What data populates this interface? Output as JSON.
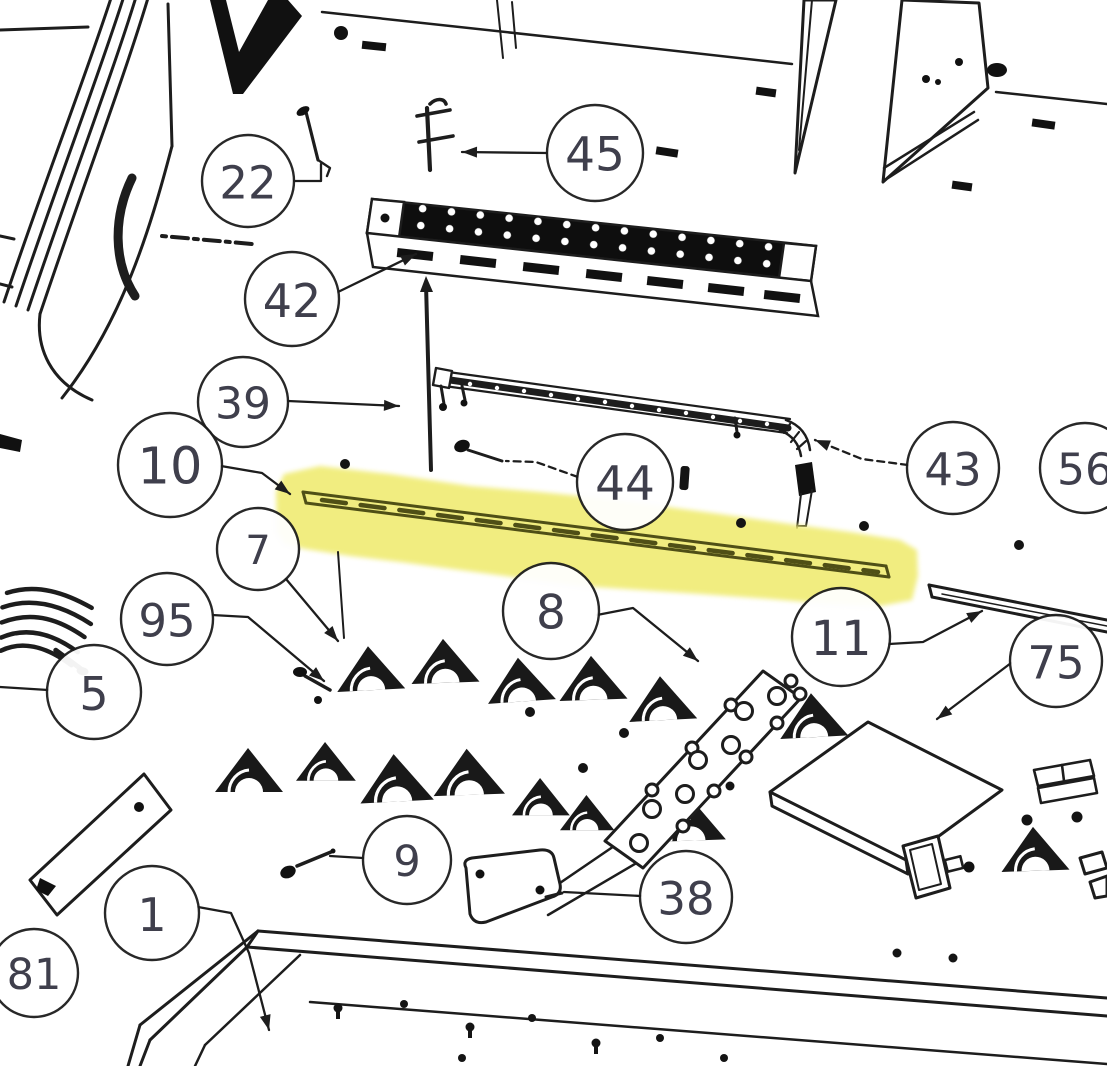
{
  "figure": {
    "kind": "exploded-parts-diagram",
    "highlighted_part_label": "10"
  },
  "colors": {
    "ink": "#1d1d1d",
    "balloon_text": "#3f3f4c",
    "highlight": "#f0ec76",
    "highlight_bar": "#4f4f16",
    "background": "#ffffff"
  },
  "callouts": [
    {
      "label": "22",
      "cx": 248,
      "cy": 181,
      "r": 46,
      "leader": [
        [
          294,
          181
        ],
        [
          321,
          181
        ],
        [
          321,
          164
        ]
      ],
      "arrow": false,
      "dashed": false
    },
    {
      "label": "45",
      "cx": 595,
      "cy": 153,
      "r": 48,
      "leader": [
        [
          547,
          153
        ],
        [
          462,
          152
        ]
      ],
      "arrow": true,
      "dashed": false
    },
    {
      "label": "42",
      "cx": 292,
      "cy": 299,
      "r": 47,
      "leader": [
        [
          338,
          292
        ],
        [
          416,
          254
        ]
      ],
      "arrow": true,
      "dashed": false
    },
    {
      "label": "39",
      "cx": 243,
      "cy": 402,
      "r": 45,
      "leader": [
        [
          288,
          401
        ],
        [
          399,
          406
        ]
      ],
      "arrow": true,
      "dashed": false
    },
    {
      "label": "10",
      "cx": 170,
      "cy": 465,
      "r": 52,
      "leader": [
        [
          221,
          466
        ],
        [
          262,
          473
        ],
        [
          290,
          494
        ]
      ],
      "arrow": true,
      "dashed": false
    },
    {
      "label": "7",
      "cx": 258,
      "cy": 549,
      "r": 41,
      "leader": [
        [
          286,
          579
        ],
        [
          338,
          641
        ]
      ],
      "arrow": true,
      "dashed": false
    },
    {
      "label": "95",
      "cx": 167,
      "cy": 619,
      "r": 46,
      "leader": [
        [
          212,
          615
        ],
        [
          248,
          617
        ],
        [
          324,
          681
        ]
      ],
      "arrow": true,
      "dashed": false
    },
    {
      "label": "5",
      "cx": 94,
      "cy": 692,
      "r": 47,
      "leader": [
        [
          48,
          690
        ],
        [
          0,
          687
        ]
      ],
      "arrow": false,
      "dashed": false
    },
    {
      "label": "44",
      "cx": 625,
      "cy": 482,
      "r": 48,
      "leader": [
        [
          578,
          477
        ],
        [
          536,
          462
        ],
        [
          506,
          461
        ]
      ],
      "arrow": false,
      "dashed": true
    },
    {
      "label": "43",
      "cx": 953,
      "cy": 468,
      "r": 46,
      "leader": [
        [
          908,
          465
        ],
        [
          862,
          459
        ],
        [
          815,
          440
        ]
      ],
      "arrow": true,
      "dashed": true
    },
    {
      "label": "56",
      "cx": 1085,
      "cy": 468,
      "r": 45,
      "leader": [],
      "arrow": false,
      "dashed": false
    },
    {
      "label": "8",
      "cx": 551,
      "cy": 611,
      "r": 48,
      "leader": [
        [
          597,
          615
        ],
        [
          633,
          608
        ],
        [
          698,
          661
        ]
      ],
      "arrow": true,
      "dashed": false
    },
    {
      "label": "11",
      "cx": 841,
      "cy": 637,
      "r": 49,
      "leader": [
        [
          889,
          644
        ],
        [
          923,
          642
        ],
        [
          982,
          611
        ]
      ],
      "arrow": true,
      "dashed": false
    },
    {
      "label": "75",
      "cx": 1056,
      "cy": 661,
      "r": 46,
      "leader": [
        [
          1011,
          663
        ],
        [
          937,
          719
        ]
      ],
      "arrow": true,
      "dashed": false
    },
    {
      "label": "9",
      "cx": 407,
      "cy": 860,
      "r": 44,
      "leader": [
        [
          363,
          858
        ],
        [
          330,
          856
        ]
      ],
      "arrow": false,
      "dashed": false
    },
    {
      "label": "38",
      "cx": 686,
      "cy": 897,
      "r": 46,
      "leader": [
        [
          641,
          896
        ],
        [
          564,
          892
        ]
      ],
      "arrow": false,
      "dashed": false
    },
    {
      "label": "1",
      "cx": 152,
      "cy": 913,
      "r": 47,
      "leader": [
        [
          198,
          907
        ],
        [
          231,
          913
        ],
        [
          249,
          953
        ],
        [
          269,
          1030
        ]
      ],
      "arrow": true,
      "dashed": false
    },
    {
      "label": "81",
      "cx": 34,
      "cy": 973,
      "r": 44,
      "leader": [],
      "arrow": false,
      "dashed": false
    }
  ],
  "highlight_polygon": [
    [
      277,
      532
    ],
    [
      276,
      492
    ],
    [
      284,
      474
    ],
    [
      320,
      466
    ],
    [
      390,
      474
    ],
    [
      470,
      486
    ],
    [
      540,
      492
    ],
    [
      600,
      498
    ],
    [
      660,
      506
    ],
    [
      720,
      514
    ],
    [
      790,
      524
    ],
    [
      850,
      532
    ],
    [
      900,
      540
    ],
    [
      917,
      550
    ],
    [
      918,
      576
    ],
    [
      912,
      600
    ],
    [
      880,
      606
    ],
    [
      830,
      604
    ],
    [
      770,
      599
    ],
    [
      700,
      594
    ],
    [
      640,
      590
    ],
    [
      580,
      586
    ],
    [
      520,
      578
    ],
    [
      460,
      570
    ],
    [
      400,
      562
    ],
    [
      350,
      556
    ],
    [
      305,
      549
    ],
    [
      285,
      544
    ]
  ]
}
